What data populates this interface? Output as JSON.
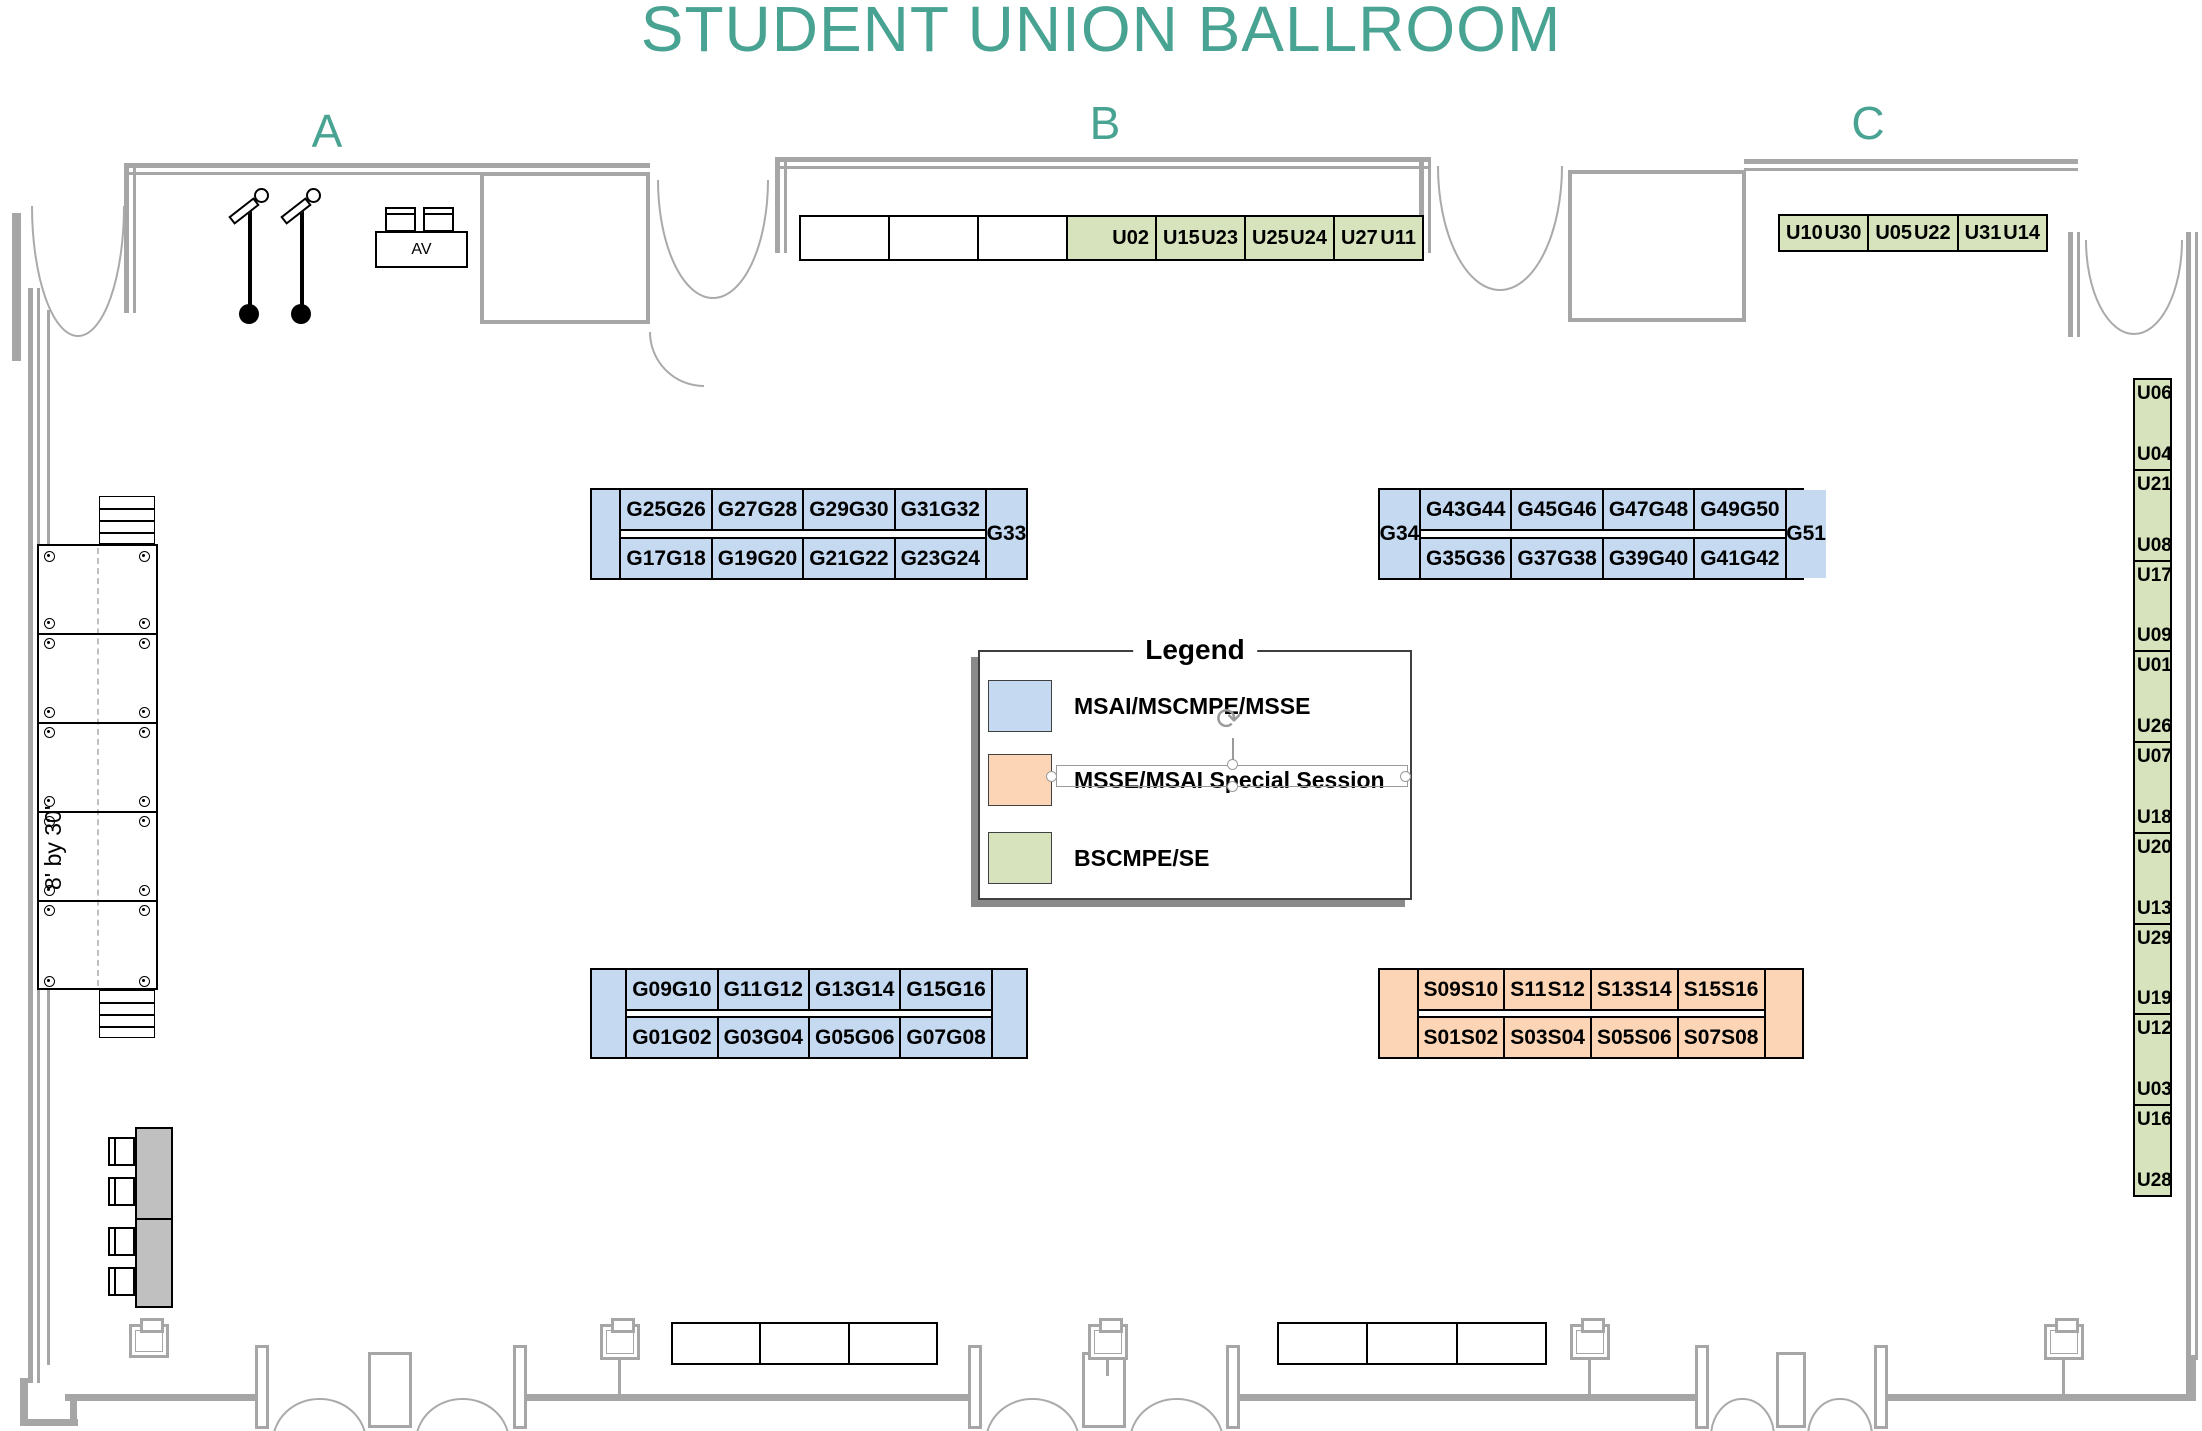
{
  "title": "STUDENT UNION BALLROOM",
  "sections": [
    {
      "label": "A"
    },
    {
      "label": "B"
    },
    {
      "label": "C"
    }
  ],
  "colors": {
    "accent": "#49A392",
    "wall": "#A6A6A6",
    "blue": "#C5D9F1",
    "green": "#D6E3BC",
    "orange": "#FBD5B5",
    "gray_table": "#C0C0C0"
  },
  "legend": {
    "title": "Legend",
    "items": [
      {
        "label": "MSAI/MSCMPE/MSSE",
        "color": "#C5D9F1"
      },
      {
        "label": "MSSE/MSAI Special Session",
        "color": "#FBD5B5"
      },
      {
        "label": "BSCMPE/SE",
        "color": "#D6E3BC"
      }
    ]
  },
  "stage": {
    "size_label": "8' by 30'"
  },
  "av_table": {
    "label": "AV"
  },
  "row_b": {
    "cells": [
      {
        "labels": [
          "",
          ""
        ]
      },
      {
        "labels": [
          "",
          ""
        ]
      },
      {
        "labels": [
          "",
          ""
        ]
      },
      {
        "labels": [
          "U02"
        ]
      },
      {
        "labels": [
          "U15",
          "U23"
        ]
      },
      {
        "labels": [
          "U25",
          "U24"
        ]
      },
      {
        "labels": [
          "U27",
          "U11"
        ]
      }
    ]
  },
  "row_c": {
    "cells": [
      {
        "labels": [
          "U10",
          "U30"
        ]
      },
      {
        "labels": [
          "U05",
          "U22"
        ]
      },
      {
        "labels": [
          "U31",
          "U14"
        ]
      }
    ]
  },
  "blocks": {
    "upper_left": {
      "cap_left": "",
      "cap_right": "G33",
      "top": [
        [
          "G25",
          "G26"
        ],
        [
          "G27",
          "G28"
        ],
        [
          "G29",
          "G30"
        ],
        [
          "G31",
          "G32"
        ]
      ],
      "bottom": [
        [
          "G17",
          "G18"
        ],
        [
          "G19",
          "G20"
        ],
        [
          "G21",
          "G22"
        ],
        [
          "G23",
          "G24"
        ]
      ]
    },
    "upper_right": {
      "cap_left": "G34",
      "cap_right": "G51",
      "top": [
        [
          "G43",
          "G44"
        ],
        [
          "G45",
          "G46"
        ],
        [
          "G47",
          "G48"
        ],
        [
          "G49",
          "G50"
        ]
      ],
      "bottom": [
        [
          "G35",
          "G36"
        ],
        [
          "G37",
          "G38"
        ],
        [
          "G39",
          "G40"
        ],
        [
          "G41",
          "G42"
        ]
      ]
    },
    "lower_left": {
      "cap_left": "",
      "cap_right": "",
      "top": [
        [
          "G09",
          "G10"
        ],
        [
          "G11",
          "G12"
        ],
        [
          "G13",
          "G14"
        ],
        [
          "G15",
          "G16"
        ]
      ],
      "bottom": [
        [
          "G01",
          "G02"
        ],
        [
          "G03",
          "G04"
        ],
        [
          "G05",
          "G06"
        ],
        [
          "G07",
          "G08"
        ]
      ]
    },
    "lower_right": {
      "cap_left": "",
      "cap_right": "",
      "top": [
        [
          "S09",
          "S10"
        ],
        [
          "S11",
          "S12"
        ],
        [
          "S13",
          "S14"
        ],
        [
          "S15",
          "S16"
        ]
      ],
      "bottom": [
        [
          "S01",
          "S02"
        ],
        [
          "S03",
          "S04"
        ],
        [
          "S05",
          "S06"
        ],
        [
          "S07",
          "S08"
        ]
      ]
    }
  },
  "right_column": {
    "cells": [
      [
        "U06",
        "U04"
      ],
      [
        "U21",
        "U08"
      ],
      [
        "U17",
        "U09"
      ],
      [
        "U01",
        "U26"
      ],
      [
        "U07",
        "U18"
      ],
      [
        "U20",
        "U13"
      ],
      [
        "U29",
        "U19"
      ],
      [
        "U12",
        "U03"
      ],
      [
        "U16",
        "U28"
      ]
    ]
  }
}
